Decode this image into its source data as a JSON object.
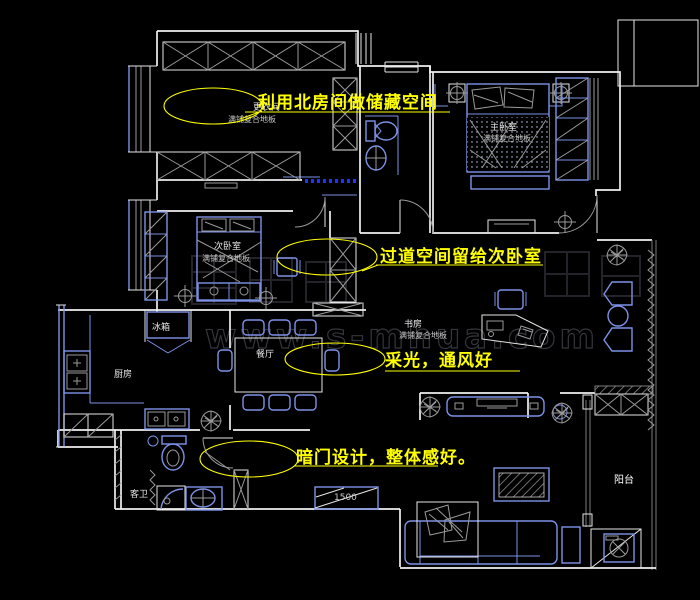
{
  "annotations": {
    "a1": {
      "text": "利用北房间做储藏空间"
    },
    "a2": {
      "text": "过道空间留给次卧室"
    },
    "a3": {
      "text": "采光，通风好"
    },
    "a4": {
      "text": "暗门设计，整体感好。"
    }
  },
  "rooms": {
    "dressing": {
      "name": "更衣间",
      "floor": "满铺复合地板"
    },
    "master": {
      "name": "主卧室",
      "floor": "满铺复合地板"
    },
    "second": {
      "name": "次卧室",
      "floor": "满铺复合地板"
    },
    "study": {
      "name": "书房",
      "floor": "满铺复合地板"
    },
    "dining": {
      "name": "餐厅"
    },
    "kitchen": {
      "name": "厨房"
    },
    "guestbath": {
      "name": "客卫"
    },
    "balcony": {
      "name": "阳台"
    }
  },
  "fixtures": {
    "fridge": "冰箱"
  },
  "dimensions": {
    "entry_cabinet": "1500"
  },
  "watermark": {
    "text": "www.s-mhua.com"
  },
  "colors": {
    "background": "#000000",
    "wall": "#f0f0f0",
    "furniture": "#7d92e6",
    "detail": "#9a9a9a",
    "annotation": "#ffff00",
    "slide_door": "#2233ff"
  }
}
